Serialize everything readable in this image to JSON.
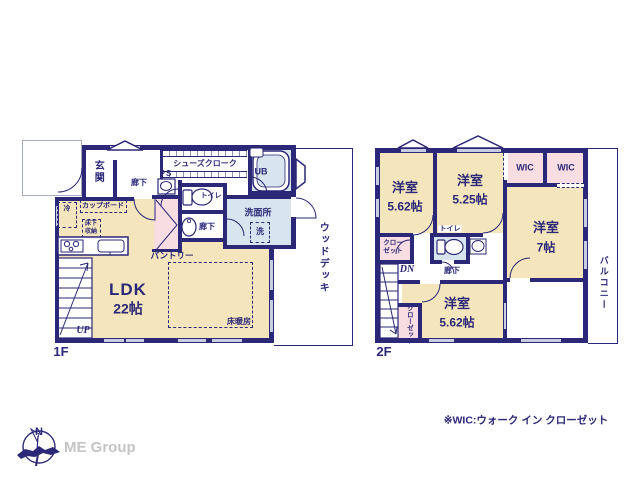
{
  "colors": {
    "wall_navy": "#2a2877",
    "room_cream": "#f5e5bc",
    "closet_pink": "#f8dde2",
    "wet_area_blue": "#d9e5ee",
    "window_fill": "#c9cde0",
    "brand_gray": "#c4c4c4"
  },
  "floor1": {
    "label": "1F",
    "entrance": "玄関",
    "hallway": "廊下",
    "ps": "PS",
    "shoes_closet": "シューズクローク",
    "unit_bath": "UB",
    "toilet": "トイレ",
    "washroom": "洗面所",
    "washer": "洗",
    "fridge": "冷",
    "cupboard": "カップボード",
    "underfloor_storage_line1": "床下",
    "underfloor_storage_line2": "収納",
    "pantry": "パントリー",
    "hallway2": "廊下",
    "ldk_name": "LDK",
    "ldk_size": "22帖",
    "floor_heating": "床暖房",
    "stairs_up": "UP",
    "wood_deck": "ウッドデッキ"
  },
  "floor2": {
    "label": "2F",
    "bedroom1_name": "洋室",
    "bedroom1_size": "5.62帖",
    "bedroom2_name": "洋室",
    "bedroom2_size": "5.25帖",
    "wic1": "WIC",
    "wic2": "WIC",
    "bedroom3_name": "洋室",
    "bedroom3_size": "7帖",
    "closet1_line1": "クロー",
    "closet1_line2": "ゼット",
    "toilet": "トイレ",
    "stairs_down": "DN",
    "hallway": "廊下",
    "bedroom4_name": "洋室",
    "bedroom4_size": "5.62帖",
    "closet2": "クローゼット",
    "balcony": "バルコニー"
  },
  "footer": {
    "compass_n": "N",
    "brand": "ME Group",
    "note": "※WIC:ウォーク イン クローゼット"
  }
}
